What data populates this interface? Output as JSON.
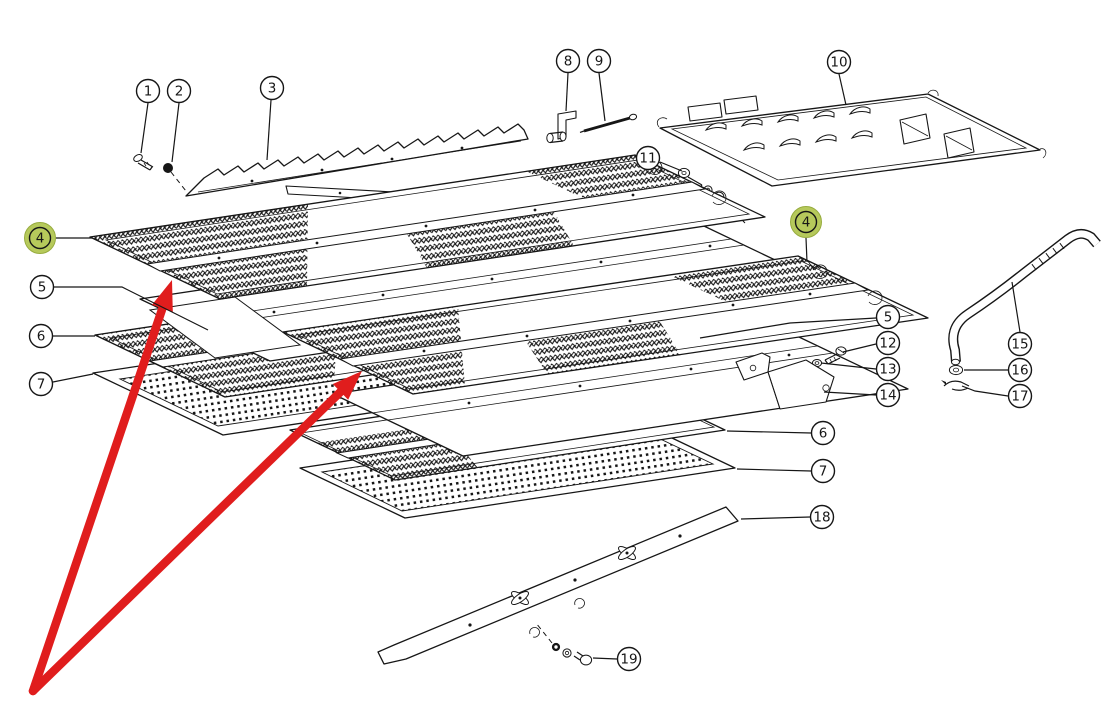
{
  "diagram": {
    "type": "exploded-parts-diagram",
    "background_color": "#ffffff",
    "line_color": "#161616",
    "highlight_fill": "#b6c95b",
    "highlight_edge": "#97ac3e",
    "arrow_color": "#e01d1d"
  },
  "callouts": [
    {
      "id": "1",
      "label": "1",
      "x": 148,
      "y": 91,
      "highlighted": false,
      "leader": [
        [
          148,
          103
        ],
        [
          141,
          153
        ]
      ]
    },
    {
      "id": "2",
      "label": "2",
      "x": 179,
      "y": 91,
      "highlighted": false,
      "leader": [
        [
          179,
          103
        ],
        [
          172,
          162
        ]
      ]
    },
    {
      "id": "3",
      "label": "3",
      "x": 272,
      "y": 88,
      "highlighted": false,
      "leader": [
        [
          271,
          100
        ],
        [
          267,
          160
        ]
      ]
    },
    {
      "id": "8",
      "label": "8",
      "x": 568,
      "y": 61,
      "highlighted": false,
      "leader": [
        [
          568,
          73
        ],
        [
          566,
          111
        ]
      ]
    },
    {
      "id": "9",
      "label": "9",
      "x": 599,
      "y": 61,
      "highlighted": false,
      "leader": [
        [
          599,
          73
        ],
        [
          605,
          121
        ]
      ]
    },
    {
      "id": "10",
      "label": "10",
      "x": 839,
      "y": 62,
      "highlighted": false,
      "leader": [
        [
          839,
          74
        ],
        [
          846,
          105
        ]
      ]
    },
    {
      "id": "11",
      "label": "11",
      "x": 648,
      "y": 158,
      "highlighted": false,
      "leader": [
        [
          660,
          162
        ],
        [
          682,
          171
        ]
      ]
    },
    {
      "id": "4-left",
      "label": "4",
      "x": 40,
      "y": 238,
      "highlighted": true,
      "leader": [
        [
          56,
          238
        ],
        [
          92,
          238
        ]
      ]
    },
    {
      "id": "5-left",
      "label": "5",
      "x": 42,
      "y": 287,
      "highlighted": false,
      "leader": [
        [
          54,
          287
        ],
        [
          122,
          287
        ],
        [
          208,
          330
        ]
      ]
    },
    {
      "id": "6-left",
      "label": "6",
      "x": 41,
      "y": 336,
      "highlighted": false,
      "leader": [
        [
          53,
          336
        ],
        [
          95,
          336
        ]
      ]
    },
    {
      "id": "7-left",
      "label": "7",
      "x": 41,
      "y": 384,
      "highlighted": false,
      "leader": [
        [
          53,
          382
        ],
        [
          93,
          374
        ]
      ]
    },
    {
      "id": "4-right",
      "label": "4",
      "x": 806,
      "y": 222,
      "highlighted": true,
      "leader": [
        [
          806,
          238
        ],
        [
          807,
          262
        ]
      ]
    },
    {
      "id": "5-right",
      "label": "5",
      "x": 888,
      "y": 317,
      "highlighted": false,
      "leader": [
        [
          876,
          318
        ],
        [
          790,
          323
        ],
        [
          700,
          338
        ]
      ]
    },
    {
      "id": "12",
      "label": "12",
      "x": 888,
      "y": 343,
      "highlighted": false,
      "leader": [
        [
          876,
          344
        ],
        [
          843,
          352
        ]
      ]
    },
    {
      "id": "13",
      "label": "13",
      "x": 888,
      "y": 369,
      "highlighted": false,
      "leader": [
        [
          876,
          369
        ],
        [
          821,
          363
        ]
      ]
    },
    {
      "id": "14",
      "label": "14",
      "x": 888,
      "y": 395,
      "highlighted": false,
      "leader": [
        [
          876,
          395
        ],
        [
          824,
          392
        ]
      ]
    },
    {
      "id": "15",
      "label": "15",
      "x": 1020,
      "y": 344,
      "highlighted": false,
      "leader": [
        [
          1020,
          332
        ],
        [
          1012,
          282
        ]
      ]
    },
    {
      "id": "16",
      "label": "16",
      "x": 1020,
      "y": 370,
      "highlighted": false,
      "leader": [
        [
          1008,
          370
        ],
        [
          964,
          370
        ]
      ]
    },
    {
      "id": "17",
      "label": "17",
      "x": 1020,
      "y": 396,
      "highlighted": false,
      "leader": [
        [
          1008,
          396
        ],
        [
          975,
          391
        ],
        [
          962,
          386
        ]
      ]
    },
    {
      "id": "6-right",
      "label": "6",
      "x": 823,
      "y": 433,
      "highlighted": false,
      "leader": [
        [
          811,
          433
        ],
        [
          727,
          431
        ]
      ]
    },
    {
      "id": "7-right",
      "label": "7",
      "x": 823,
      "y": 471,
      "highlighted": false,
      "leader": [
        [
          811,
          471
        ],
        [
          737,
          469
        ]
      ]
    },
    {
      "id": "18",
      "label": "18",
      "x": 822,
      "y": 517,
      "highlighted": false,
      "leader": [
        [
          810,
          517
        ],
        [
          741,
          519
        ]
      ]
    },
    {
      "id": "19",
      "label": "19",
      "x": 629,
      "y": 659,
      "highlighted": false,
      "leader": [
        [
          617,
          659
        ],
        [
          593,
          658
        ]
      ]
    }
  ],
  "arrows": [
    {
      "id": "arrow-left",
      "from": [
        33,
        691
      ],
      "to": [
        172,
        280
      ]
    },
    {
      "id": "arrow-right",
      "from": [
        33,
        691
      ],
      "to": [
        362,
        371
      ]
    }
  ]
}
